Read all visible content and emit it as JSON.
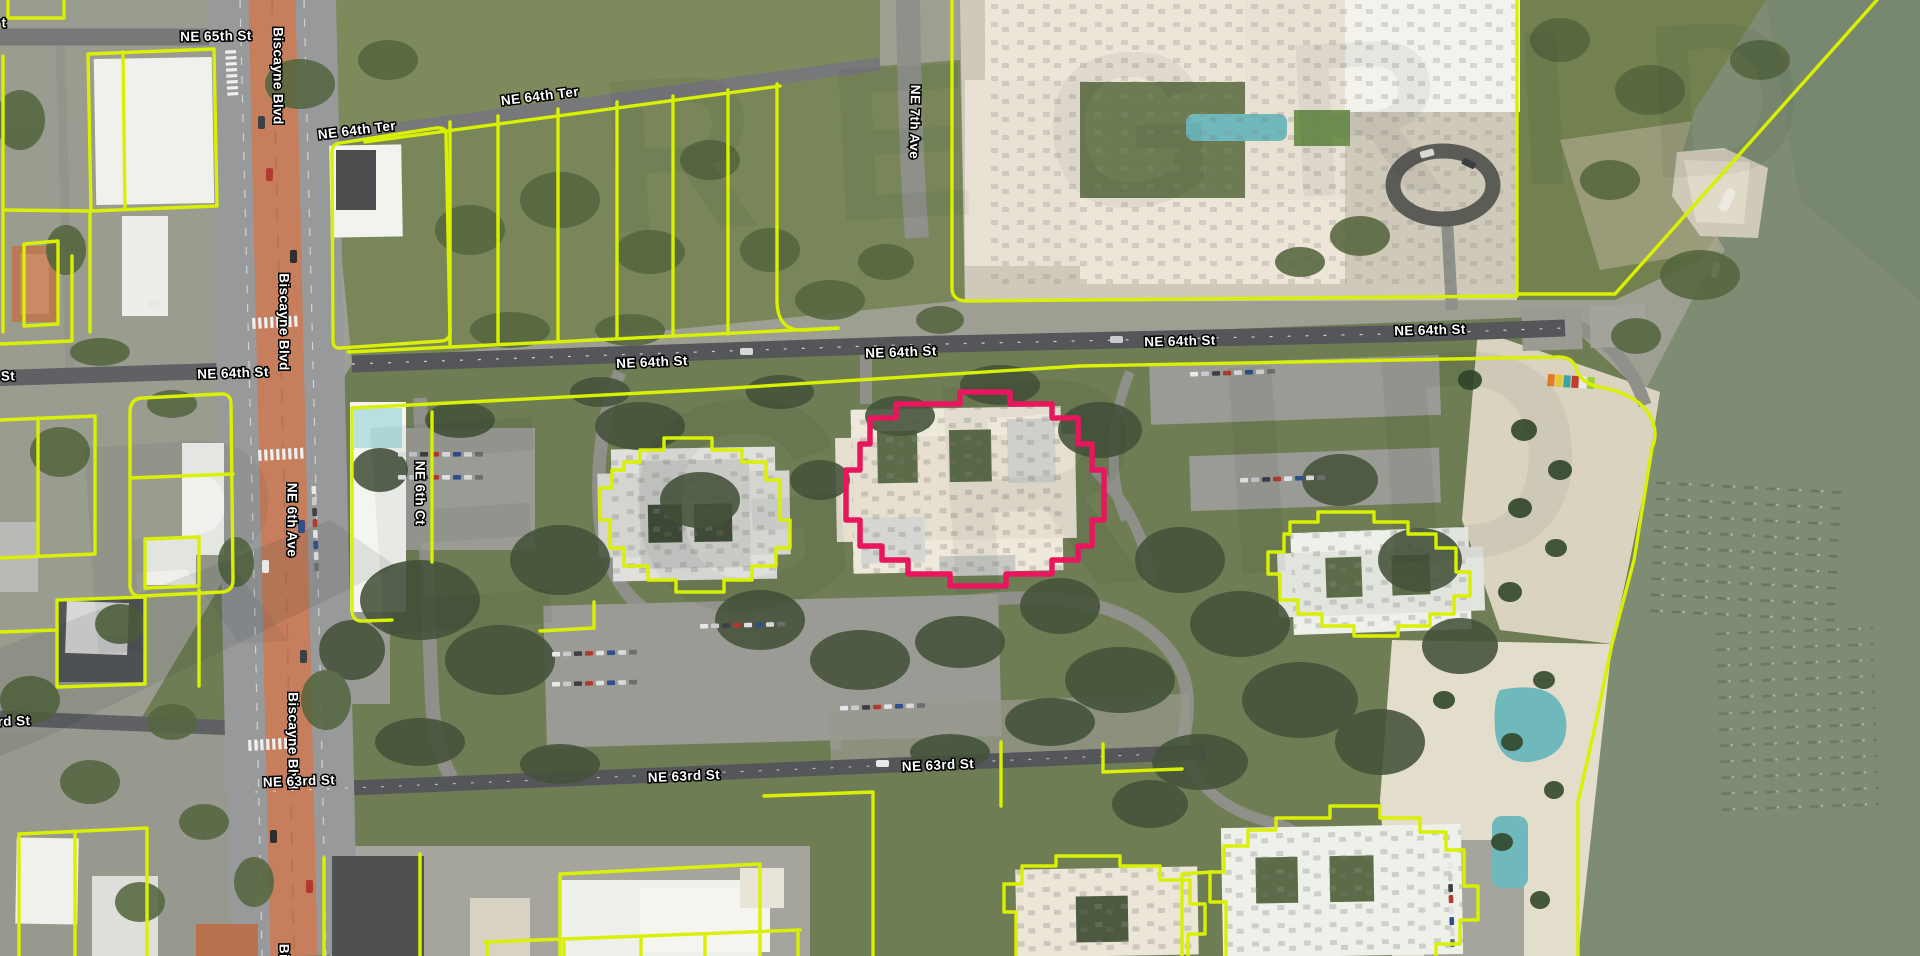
{
  "app": {
    "view": "aerial-parcel-map",
    "watermark": "REGRID"
  },
  "map": {
    "street_labels": [
      {
        "text": "t",
        "x": 4,
        "y": 24,
        "r": 0
      },
      {
        "text": "NE 65th St",
        "x": 216,
        "y": 37,
        "r": -1
      },
      {
        "text": "Biscayne Blvd",
        "x": 277,
        "y": 76,
        "r": 90
      },
      {
        "text": "NE 64th Ter",
        "x": 357,
        "y": 131,
        "r": -7
      },
      {
        "text": "NE 64th Ter",
        "x": 540,
        "y": 97,
        "r": -7
      },
      {
        "text": "NE 7th Ave",
        "x": 914,
        "y": 122,
        "r": 91
      },
      {
        "text": "St",
        "x": 8,
        "y": 377,
        "r": -2
      },
      {
        "text": "NE 64th St",
        "x": 233,
        "y": 374,
        "r": -2
      },
      {
        "text": "NE 64th St",
        "x": 652,
        "y": 363,
        "r": -2.5
      },
      {
        "text": "NE 64th St",
        "x": 901,
        "y": 353,
        "r": -2
      },
      {
        "text": "NE 64th St",
        "x": 1180,
        "y": 342,
        "r": -1.5
      },
      {
        "text": "NE 64th St",
        "x": 1430,
        "y": 331,
        "r": -1.5
      },
      {
        "text": "Biscayne Blvd",
        "x": 283,
        "y": 322,
        "r": 90
      },
      {
        "text": "NE 6th Ave",
        "x": 291,
        "y": 520,
        "r": 90
      },
      {
        "text": "NE 6th Ct",
        "x": 419,
        "y": 493,
        "r": 90
      },
      {
        "text": "Biscayne Blvd",
        "x": 292,
        "y": 741,
        "r": 90
      },
      {
        "text": "rd St",
        "x": 14,
        "y": 722,
        "r": -2
      },
      {
        "text": "NE 63rd St",
        "x": 299,
        "y": 782,
        "r": -2
      },
      {
        "text": "NE 63rd St",
        "x": 684,
        "y": 777,
        "r": -2.5
      },
      {
        "text": "NE 63rd St",
        "x": 938,
        "y": 766,
        "r": -2.5
      },
      {
        "text": "Bi",
        "x": 283,
        "y": 951,
        "r": 90
      }
    ],
    "colors": {
      "parcel_line": "#d9f000",
      "selected_parcel": "#e8175d",
      "water": "#7e8c74",
      "biscayne_median": "#c67e5c",
      "road_major": "#595b5f",
      "road_minor": "#8f9089",
      "grass": "#778457",
      "tree_canopy": "#44523a",
      "sand": "#dad3c0",
      "building_light": "#f1f1ec",
      "building_cream": "#ece5d7",
      "pool": "#6fb9bd"
    }
  }
}
